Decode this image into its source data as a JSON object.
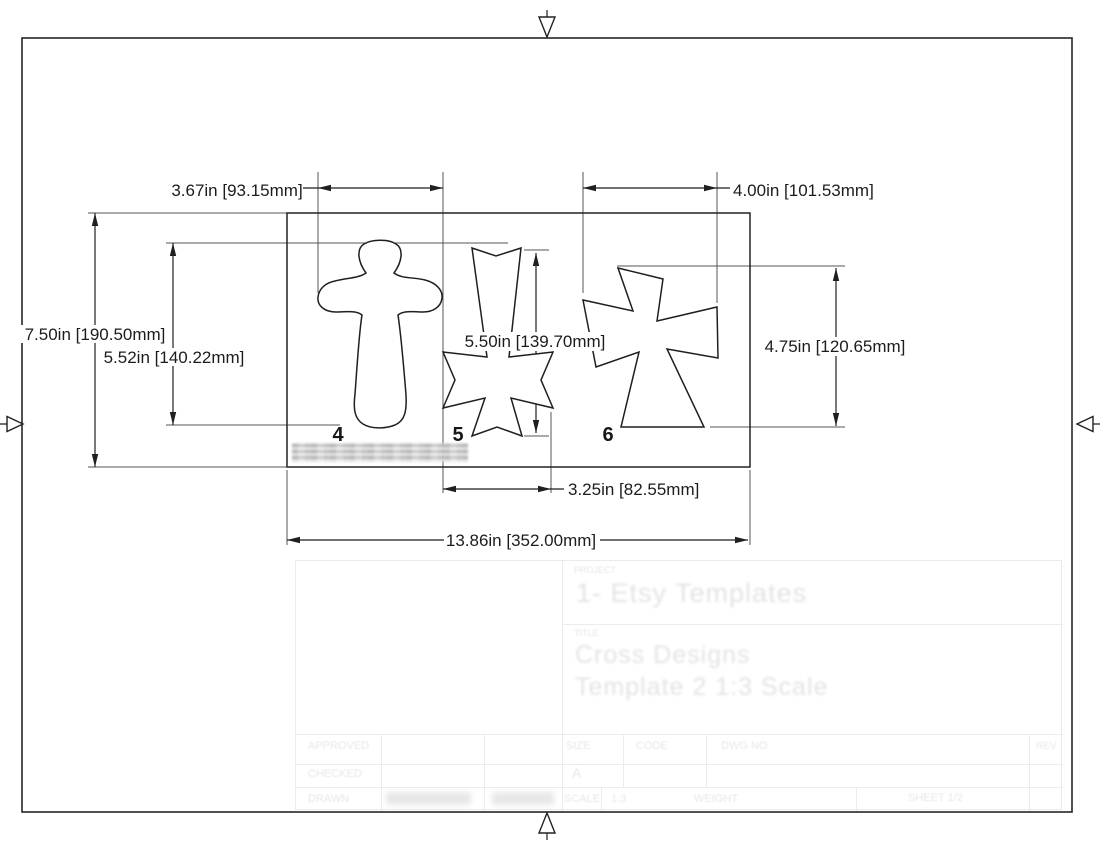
{
  "colors": {
    "line": "#1f1f1f",
    "extension_line": "#555555",
    "faded_titleblock": "#e7e7e7",
    "background": "#ffffff"
  },
  "drawing": {
    "item_numbers": [
      "4",
      "5",
      "6"
    ],
    "dimensions": {
      "cross4_width": "3.67in [93.15mm]",
      "cross6_width": "4.00in [101.53mm]",
      "stencil_height": "7.50in [190.50mm]",
      "cross4_height": "5.52in [140.22mm]",
      "cross5_height": "5.50in [139.70mm]",
      "cross6_height": "4.75in [120.65mm]",
      "cross5_width": "3.25in [82.55mm]",
      "stencil_width": "13.86in [352.00mm]"
    },
    "redactions": [
      {
        "location": "label-under-cross-4"
      },
      {
        "location": "drawn-name"
      },
      {
        "location": "drawn-date"
      }
    ]
  },
  "title_block": {
    "project_label": "PROJECT",
    "project_value": "1- Etsy Templates",
    "title_label": "TITLE",
    "title_line1": "Cross Designs",
    "title_line2": "Template 2 1:3 Scale",
    "approved_label": "APPROVED",
    "checked_label": "CHECKED",
    "drawn_label": "DRAWN",
    "size_label": "SIZE",
    "size_value": "A",
    "code_label": "CODE",
    "dwg_no_label": "DWG NO",
    "rev_label": "REV",
    "scale_label": "SCALE",
    "scale_value": "1:3",
    "weight_label": "WEIGHT",
    "sheet_label": "SHEET 1/2"
  }
}
